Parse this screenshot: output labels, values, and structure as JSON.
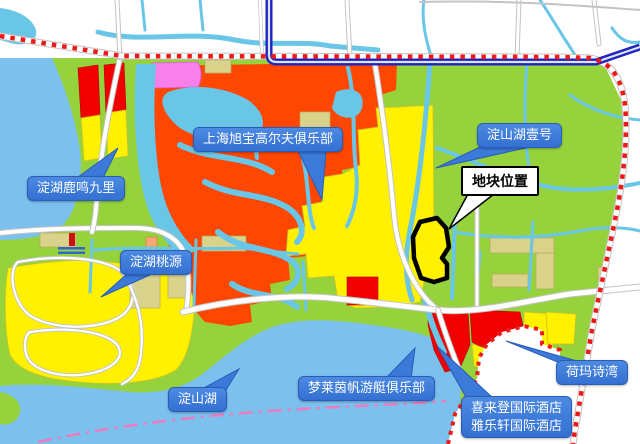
{
  "map": {
    "kind": "plot-location-map",
    "labels": {
      "luming": {
        "text": "淀湖鹿鸣九里"
      },
      "xubao": {
        "text": "上海旭宝高尔夫俱乐部"
      },
      "yihao": {
        "text": "淀山湖壹号"
      },
      "plot": {
        "text": "地块位置"
      },
      "taoyuan": {
        "text": "淀湖桃源"
      },
      "lake": {
        "text": "淀山湖"
      },
      "marina": {
        "text": "梦莱茵帆游艇俱乐部"
      },
      "hotels": {
        "line1": "喜来登国际酒店",
        "line2": "雅乐轩国际酒店"
      },
      "hema": {
        "text": "荷玛诗湾"
      }
    },
    "colors": {
      "land": "#96D23C",
      "lake": "#7CC0EE",
      "stream": "#69C6E6",
      "yellow": "#FFF100",
      "red": "#F20000",
      "orange": "#FF4702",
      "pink": "#F97FEA",
      "khaki": "#D9D28B",
      "navy": "#2222BE",
      "dotred": "#F01818",
      "pinkline": "#EE7BBF",
      "callout": "#3B7AD9"
    }
  }
}
